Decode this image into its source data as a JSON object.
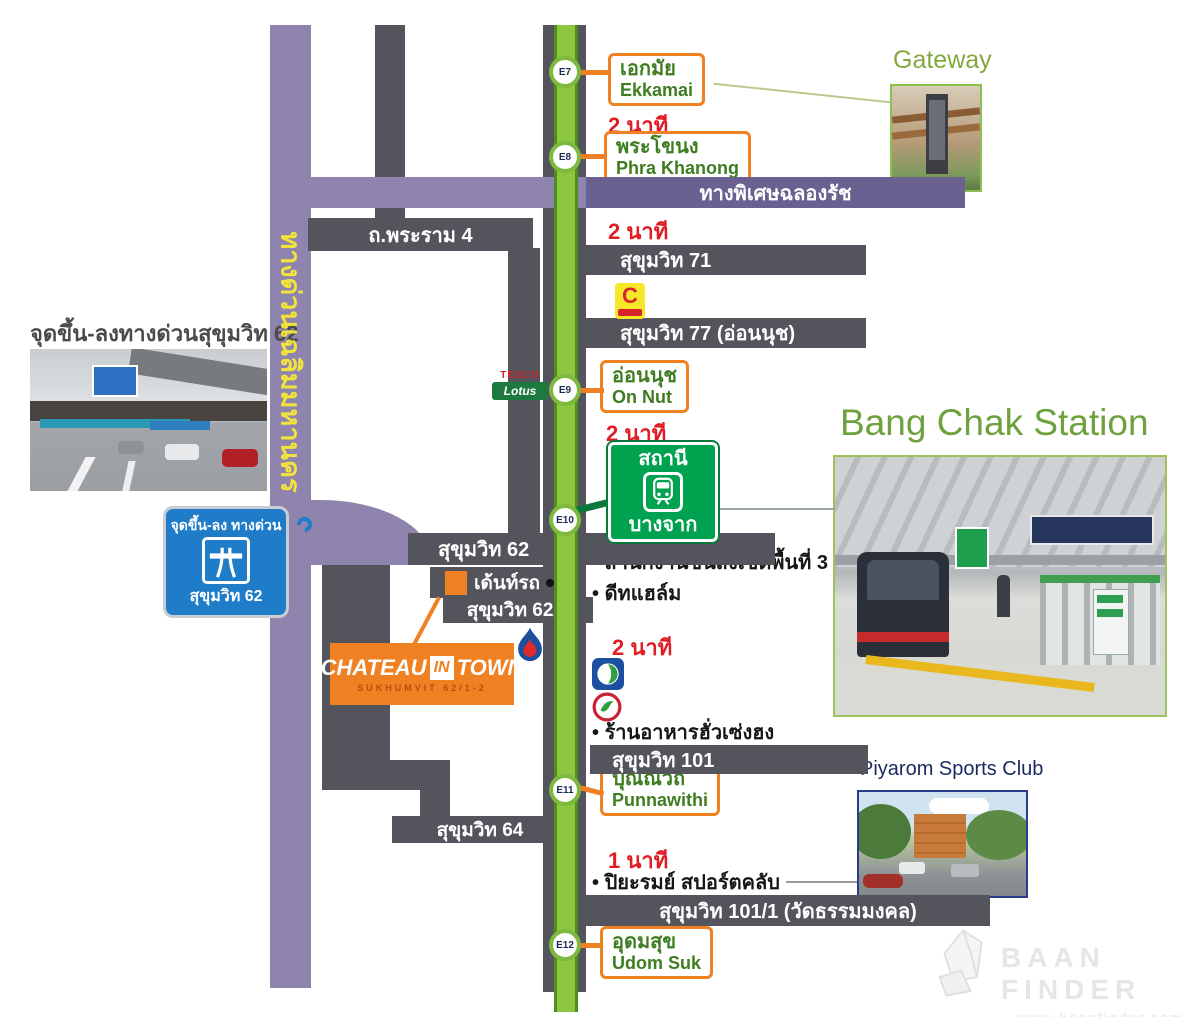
{
  "roads": {
    "expressway_vertical": "ทางด่วนเฉลิมมหานคร",
    "chalong_rat": "ทางพิเศษฉลองรัช",
    "rama4": "ถ.พระราม 4",
    "suk71": "สุขุมวิท 71",
    "suk77": "สุขุมวิท 77 (อ่อนนุช)",
    "suk62": "สุขุมวิท 62",
    "suk621": "สุขุมวิท 62/1",
    "suk64": "สุขุมวิท 64",
    "suk101": "สุขุมวิท 101",
    "suk1011": "สุขุมวิท 101/1 (วัดธรรมมงคล)"
  },
  "stations": [
    {
      "code": "E7",
      "thai": "เอกมัย",
      "en": "Ekkamai"
    },
    {
      "code": "E8",
      "thai": "พระโขนง",
      "en": "Phra Khanong"
    },
    {
      "code": "E9",
      "thai": "อ่อนนุช",
      "en": "On Nut"
    },
    {
      "code": "E10",
      "thai": "บางจาก",
      "en": "Bang Chak"
    },
    {
      "code": "E11",
      "thai": "ปุณณวิถี",
      "en": "Punnawithi"
    },
    {
      "code": "E12",
      "thai": "อุดมสุข",
      "en": "Udom Suk"
    }
  ],
  "bts_sign": {
    "top_label": "สถานี",
    "bottom_label": "บางจาก"
  },
  "travel_times": [
    "2 นาที",
    "2 นาที",
    "2 นาที",
    "2 นาที",
    "1 นาที"
  ],
  "landmarks": {
    "transport_office": "สำนักงานขนส่งเขตพื้นที่ 3",
    "diethelm": "ดีทแฮล์ม",
    "restaurant": "ร้านอาหารฮั่วเซ่งฮง",
    "piyarom": "ปิยะรมย์ สปอร์ตคลับ",
    "dent_shop": "เด้นท์รถ"
  },
  "toll_sign": {
    "line1": "จุดขึ้น-ลง ทางด่วน",
    "line2": "สุขุมวิท 62"
  },
  "project": {
    "name1": "CHATEAU",
    "name2": "IN",
    "name3": "TOWN",
    "subtitle": "SUKHUMVIT 62/1-2"
  },
  "photos": {
    "toll": {
      "caption": "จุดขึ้น-ลงทางด่วนสุขุมวิท 62"
    },
    "gateway": {
      "caption": "Gateway"
    },
    "bangchak": {
      "caption": "Bang Chak Station"
    },
    "piyarom": {
      "caption": "Piyarom Sports Club"
    }
  },
  "logos": {
    "tesco_top": "TESCO",
    "tesco_bottom": "Lotus",
    "bigc_letter": "C"
  },
  "watermark": {
    "title": "BAAN FINDER",
    "url": "www.baanfinder.com"
  },
  "colors": {
    "accent_orange": "#f08122",
    "bts_green": "#8dc63f",
    "sign_green": "#00a14f",
    "road_gray": "#54555c",
    "expressway_purple": "#8e84ad",
    "minute_red": "#e01c24",
    "toll_blue": "#1e7cc8"
  }
}
